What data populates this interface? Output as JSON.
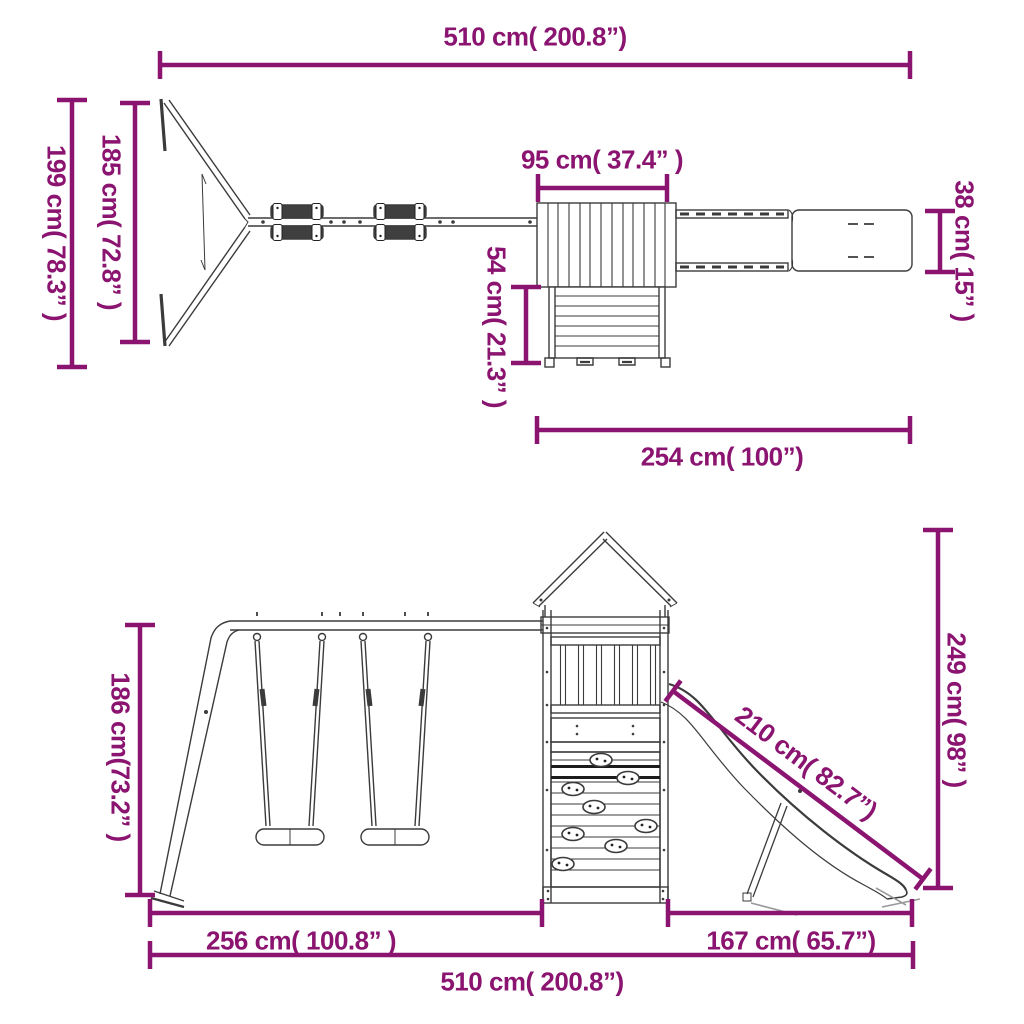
{
  "diagram": {
    "accent_color": "#8A1470",
    "line_color": "#3B3B3B",
    "top_view": {
      "overall_width": "510 cm( 200.8”)",
      "depth_overall": "199 cm( 78.3” )",
      "depth_frame": "185 cm( 72.8” )",
      "roof_width": "95 cm( 37.4” )",
      "platform_depth": "54 cm( 21.3” )",
      "slide_width": "38 cm( 15” )",
      "tower_slide_length": "254 cm( 100”)"
    },
    "front_view": {
      "swing_frame_height": "186 cm(73.2” )",
      "swing_section_width": "256 cm( 100.8” )",
      "slide_section_width": "167 cm( 65.7”)",
      "slide_length": "210 cm( 82.7”)",
      "tower_height": "249 cm( 98” )",
      "overall_width": "510 cm( 200.8”)"
    }
  }
}
